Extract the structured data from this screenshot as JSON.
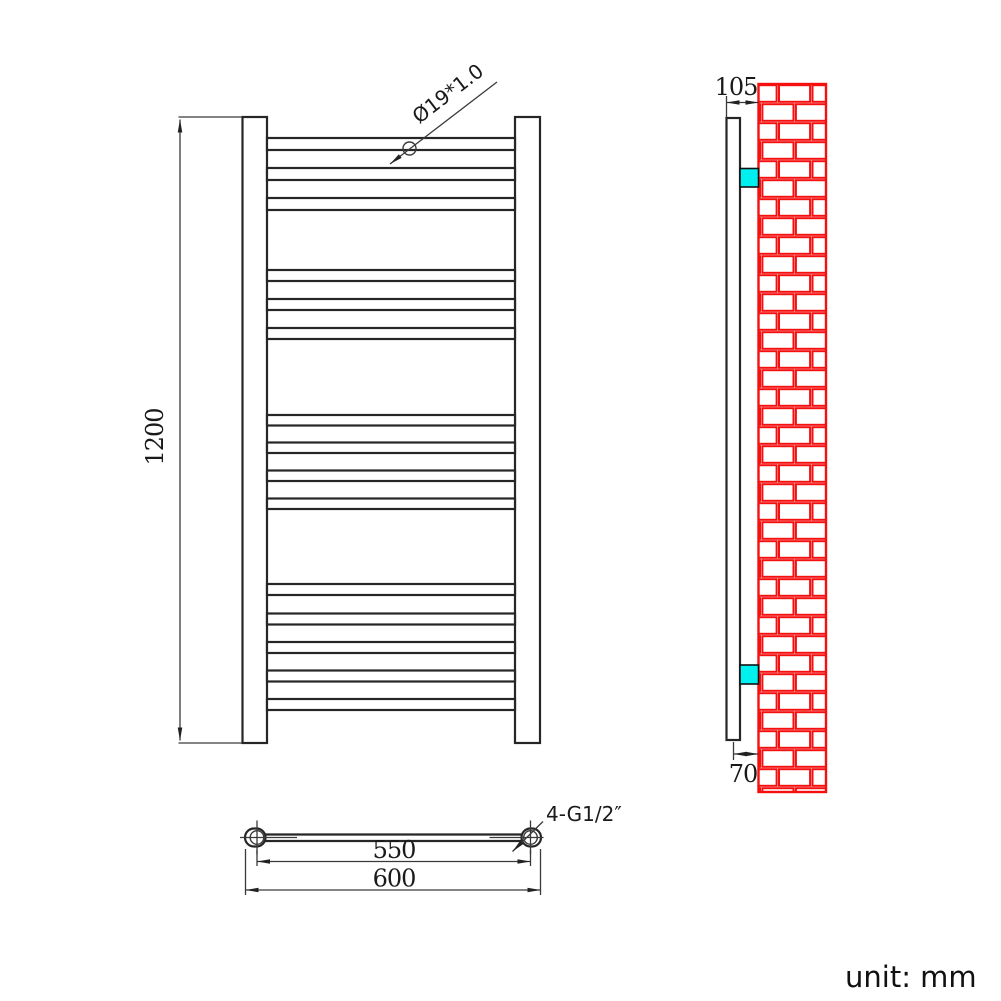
{
  "colors": {
    "line": "#262626",
    "dim": "#3a3a3a",
    "brick_red": "#f50f0f",
    "bracket_cyan": "#00f0f0",
    "background": "#ffffff"
  },
  "labels": {
    "height_dim": "1200",
    "tube_dia_callout": "Ø19*1.0",
    "inner_width_dim": "550",
    "outer_width_dim": "600",
    "connections_callout": "4-G1/2″",
    "top_offset_dim": "105",
    "wall_offset_dim": "70",
    "unit_note": "unit: mm"
  },
  "drawing": {
    "front_view": {
      "bars_x": 267,
      "bars_width": 248,
      "bar_groups": [
        {
          "tops": [
            138,
            168,
            198
          ],
          "height": 12
        },
        {
          "tops": [
            270,
            299,
            328
          ],
          "height": 11
        },
        {
          "tops": [
            415,
            442.5,
            470.5,
            498.5
          ],
          "height": 10.5
        },
        {
          "tops": [
            584,
            613.5,
            642,
            670.5,
            699
          ],
          "height": 11
        }
      ]
    },
    "side_view": {
      "wall": {
        "x": 758.5,
        "y": 84,
        "w": 67.5,
        "h": 708,
        "row_h": 19,
        "brick_w": 33.5,
        "even_offset": 19.3,
        "odd_offset": 2.7,
        "inset": 1.2
      }
    }
  }
}
